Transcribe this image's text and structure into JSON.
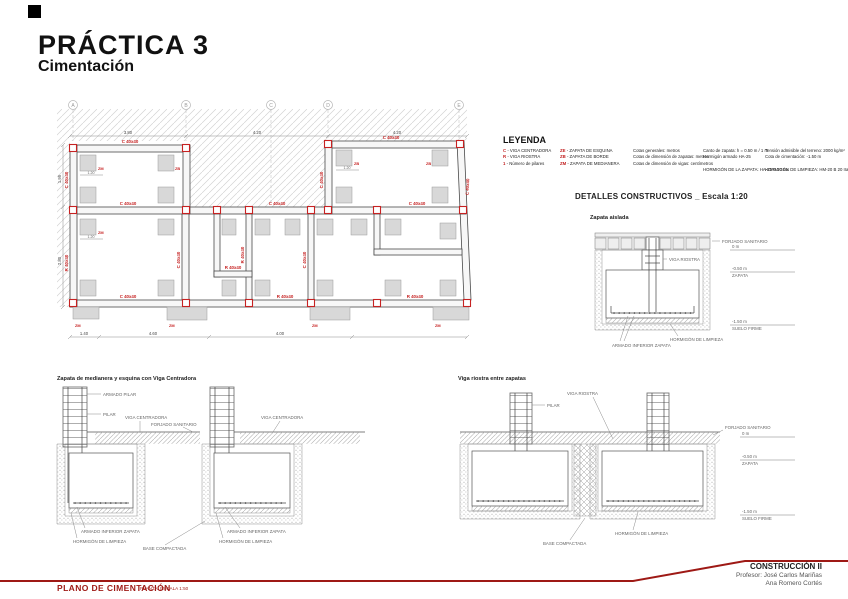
{
  "meta": {
    "title": "PRÁCTICA 3",
    "subtitle": "Cimentación"
  },
  "legend": {
    "heading": "LEYENDA",
    "col1": [
      {
        "key": "C",
        "text": "- VIGA CENTRADORA"
      },
      {
        "key": "R",
        "text": "- VIGA RIOSTRA"
      },
      {
        "key": "1",
        "text": "- Número de pilares"
      }
    ],
    "col2": [
      {
        "key": "ZE",
        "text": "- ZAPATA DE ESQUINA"
      },
      {
        "key": "ZB",
        "text": "- ZAPATA DE BORDE"
      },
      {
        "key": "ZM",
        "text": "- ZAPATA DE MEDIANERA"
      }
    ],
    "col3": [
      "Cotas generales: metros",
      "Cotas de dimensión de zapatas: metros",
      "Cotas de dimensión de vigas: centímetros"
    ],
    "col4": [
      "Canto de zapata: h = 0.50 m / 1 m",
      "Hormigón armado HA-25",
      "HORMIGÓN DE LA ZAPATA: HA-25 B 20 IIa"
    ],
    "col5": [
      "Tensión admisible del terreno: 2000 kg/m²",
      "Cota de cimentación: -1.50 m",
      "HORMIGÓN DE LIMPIEZA: HM-20 B 20 IIa"
    ]
  },
  "plan": {
    "grid": [
      "A",
      "B",
      "C",
      "D",
      "E"
    ],
    "beam_c": "C 40x40",
    "beam_r": "R 40x40",
    "zm": "ZM",
    "zb": "ZB",
    "dims": {
      "top": [
        "3.80",
        "4.20",
        "4.20"
      ],
      "left": [
        "1.95",
        "2.80"
      ],
      "bottom": [
        "1.40",
        "4.60",
        "4.00"
      ],
      "small": "1.20"
    }
  },
  "details": {
    "heading": "DETALLES CONSTRUCTIVOS _ Escala 1:20",
    "isolated_title": "Zapata aislada",
    "left_title": "Zapata de medianera y esquina con Viga Centradora",
    "right_title": "Viga riostra entre zapatas",
    "labels": {
      "forjado": "FORJADO SANITARIO",
      "viga_riostra": "VIGA RIOSTRA",
      "viga_centradora": "VIGA CENTRADORA",
      "pilar": "PILAR",
      "armado_pilar": "ARMADO PILAR",
      "armado_inferior": "ARMADO INFERIOR ZAPATA",
      "limpieza": "HORMIGÓN DE LIMPIEZA",
      "base": "BASE COMPACTADA"
    },
    "levels": {
      "l0": "0 m",
      "l05": "-0.50 m",
      "zapata": "ZAPATA",
      "l15": "-1.50 m",
      "firme": "SUELO FIRME"
    }
  },
  "footer": {
    "left_title": "PLANO DE CIMENTACIÓN",
    "left_scale": "PLANTA: ESCALA 1:50",
    "course": "CONSTRUCCIÓN II",
    "professor": "Profesor: José Carlos Mariñas",
    "student": "Ana Romero Cortés"
  }
}
